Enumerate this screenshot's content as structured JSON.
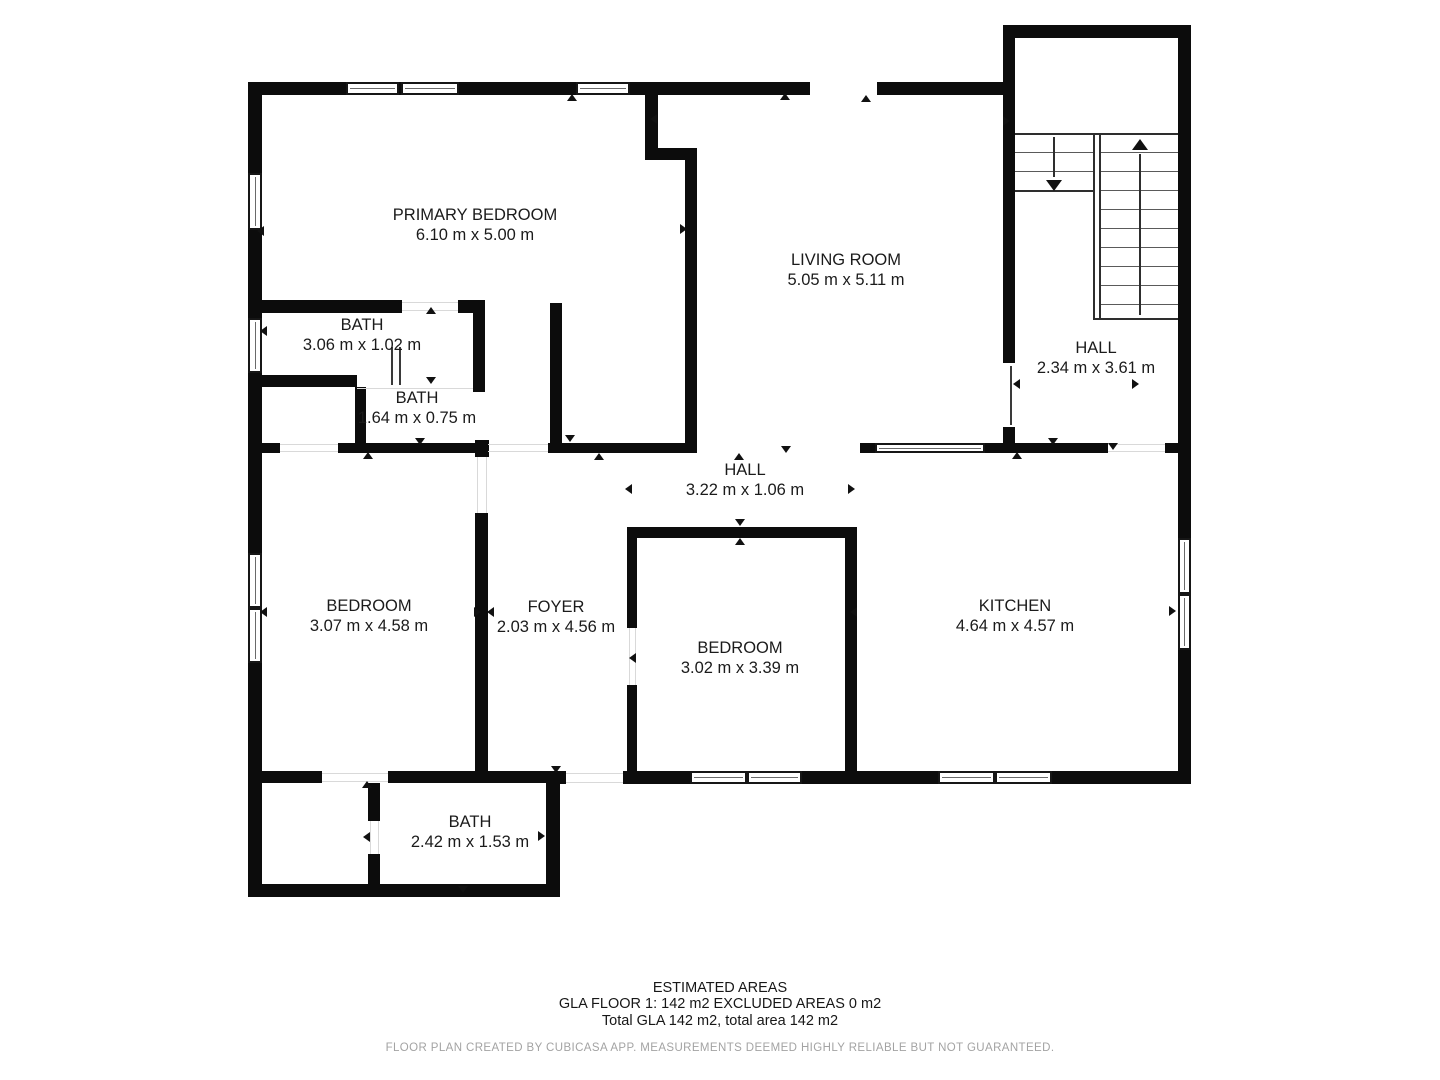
{
  "footer": {
    "title": "ESTIMATED AREAS",
    "line1": "GLA FLOOR 1: 142 m2 EXCLUDED AREAS 0 m2",
    "line2": "Total GLA 142 m2, total area 142 m2",
    "disclaimer": "FLOOR PLAN CREATED BY CUBICASA APP. MEASUREMENTS DEEMED HIGHLY RELIABLE BUT NOT GUARANTEED."
  },
  "colors": {
    "wall": "#0c0c0c",
    "label_text": "#1b1b1b",
    "disclaimer_text": "#a3a3a3"
  },
  "floorplan": {
    "rooms": [
      {
        "name": "PRIMARY BEDROOM",
        "dims": "6.10 m x 5.00 m",
        "x": 475,
        "y": 205
      },
      {
        "name": "LIVING ROOM",
        "dims": "5.05 m x 5.11 m",
        "x": 846,
        "y": 250
      },
      {
        "name": "BATH",
        "dims": "3.06 m x 1.02 m",
        "x": 362,
        "y": 315
      },
      {
        "name": "BATH",
        "dims": "1.64 m x 0.75 m",
        "x": 417,
        "y": 388
      },
      {
        "name": "HALL",
        "dims": "2.34 m x 3.61 m",
        "x": 1096,
        "y": 338
      },
      {
        "name": "HALL",
        "dims": "3.22 m x 1.06 m",
        "x": 745,
        "y": 460
      },
      {
        "name": "BEDROOM",
        "dims": "3.07 m x 4.58 m",
        "x": 369,
        "y": 596
      },
      {
        "name": "FOYER",
        "dims": "2.03 m x 4.56 m",
        "x": 556,
        "y": 597
      },
      {
        "name": "BEDROOM",
        "dims": "3.02 m x 3.39 m",
        "x": 740,
        "y": 638
      },
      {
        "name": "KITCHEN",
        "dims": "4.64 m x 4.57 m",
        "x": 1015,
        "y": 596
      },
      {
        "name": "BATH",
        "dims": "2.42 m x 1.53 m",
        "x": 470,
        "y": 812
      }
    ],
    "walls": [
      [
        248,
        82,
        14,
        815
      ],
      [
        248,
        82,
        562,
        13
      ],
      [
        877,
        82,
        138,
        13
      ],
      [
        1003,
        25,
        188,
        13
      ],
      [
        1003,
        25,
        12,
        70
      ],
      [
        1178,
        25,
        13,
        759
      ],
      [
        623,
        771,
        68,
        13
      ],
      [
        802,
        771,
        138,
        13
      ],
      [
        1050,
        771,
        141,
        13
      ],
      [
        546,
        771,
        20,
        13
      ],
      [
        546,
        771,
        14,
        126
      ],
      [
        248,
        884,
        312,
        13
      ],
      [
        250,
        771,
        72,
        12
      ],
      [
        388,
        771,
        158,
        12
      ],
      [
        645,
        95,
        13,
        60
      ],
      [
        645,
        148,
        52,
        12
      ],
      [
        685,
        148,
        12,
        304
      ],
      [
        1003,
        95,
        12,
        268
      ],
      [
        1003,
        427,
        12,
        25
      ],
      [
        250,
        300,
        152,
        13
      ],
      [
        458,
        300,
        27,
        13
      ],
      [
        473,
        300,
        12,
        92
      ],
      [
        250,
        375,
        107,
        12
      ],
      [
        355,
        387,
        11,
        58
      ],
      [
        550,
        303,
        12,
        148
      ],
      [
        250,
        443,
        30,
        10
      ],
      [
        338,
        443,
        137,
        10
      ],
      [
        475,
        440,
        14,
        17
      ],
      [
        548,
        443,
        149,
        10
      ],
      [
        475,
        513,
        13,
        260
      ],
      [
        627,
        527,
        226,
        11
      ],
      [
        627,
        527,
        10,
        101
      ],
      [
        627,
        685,
        10,
        88
      ],
      [
        845,
        527,
        12,
        246
      ],
      [
        860,
        443,
        16,
        10
      ],
      [
        984,
        443,
        124,
        10
      ],
      [
        1165,
        443,
        26,
        10
      ],
      [
        368,
        783,
        12,
        38
      ],
      [
        368,
        854,
        12,
        31
      ]
    ],
    "windows": [
      [
        346,
        82,
        53,
        13,
        "h"
      ],
      [
        401,
        82,
        58,
        13,
        "h"
      ],
      [
        576,
        82,
        54,
        13,
        "h"
      ],
      [
        248,
        173,
        14,
        57,
        "v"
      ],
      [
        248,
        318,
        14,
        55,
        "v"
      ],
      [
        248,
        553,
        14,
        55,
        "v"
      ],
      [
        248,
        608,
        14,
        55,
        "v"
      ],
      [
        1178,
        538,
        13,
        56,
        "v"
      ],
      [
        1178,
        594,
        13,
        56,
        "v"
      ],
      [
        690,
        771,
        57,
        13,
        "h"
      ],
      [
        747,
        771,
        55,
        13,
        "h"
      ],
      [
        938,
        771,
        57,
        13,
        "h"
      ],
      [
        995,
        771,
        57,
        13,
        "h"
      ],
      [
        875,
        443,
        110,
        10,
        "h"
      ]
    ],
    "jambs": [
      [
        391,
        347,
        2,
        38
      ],
      [
        399,
        347,
        2,
        38
      ],
      [
        1010,
        366,
        2,
        59
      ]
    ],
    "thresholds": [
      [
        280,
        444,
        58,
        1
      ],
      [
        280,
        451,
        58,
        1
      ],
      [
        402,
        302,
        56,
        1
      ],
      [
        402,
        310,
        56,
        1
      ],
      [
        477,
        457,
        1,
        56
      ],
      [
        486,
        457,
        1,
        56
      ],
      [
        566,
        773,
        57,
        1
      ],
      [
        566,
        782,
        57,
        1
      ],
      [
        322,
        773,
        66,
        1
      ],
      [
        322,
        781,
        66,
        1
      ],
      [
        370,
        821,
        1,
        33
      ],
      [
        378,
        821,
        1,
        33
      ],
      [
        1108,
        444,
        57,
        1
      ],
      [
        1108,
        451,
        57,
        1
      ],
      [
        629,
        628,
        1,
        57
      ],
      [
        635,
        628,
        1,
        57
      ],
      [
        488,
        444,
        60,
        1
      ],
      [
        488,
        451,
        60,
        1
      ],
      [
        357,
        388,
        116,
        1
      ]
    ],
    "markers": [
      [
        572,
        97,
        "up"
      ],
      [
        785,
        96,
        "up"
      ],
      [
        866,
        98,
        "up"
      ],
      [
        653,
        119,
        "left"
      ],
      [
        1006,
        121,
        "right"
      ],
      [
        683,
        229,
        "right"
      ],
      [
        260,
        231,
        "left"
      ],
      [
        431,
        310,
        "up"
      ],
      [
        263,
        331,
        "left"
      ],
      [
        431,
        380,
        "down"
      ],
      [
        1016,
        384,
        "left"
      ],
      [
        1135,
        384,
        "right"
      ],
      [
        570,
        438,
        "down"
      ],
      [
        420,
        441,
        "down"
      ],
      [
        739,
        456,
        "up"
      ],
      [
        786,
        449,
        "down"
      ],
      [
        368,
        455,
        "up"
      ],
      [
        599,
        456,
        "up"
      ],
      [
        1017,
        455,
        "up"
      ],
      [
        1053,
        441,
        "down"
      ],
      [
        1113,
        446,
        "down"
      ],
      [
        628,
        489,
        "left"
      ],
      [
        851,
        489,
        "right"
      ],
      [
        740,
        522,
        "down"
      ],
      [
        740,
        541,
        "up"
      ],
      [
        263,
        612,
        "left"
      ],
      [
        477,
        612,
        "right"
      ],
      [
        490,
        612,
        "left"
      ],
      [
        632,
        658,
        "left"
      ],
      [
        853,
        612,
        "left"
      ],
      [
        1172,
        611,
        "right"
      ],
      [
        367,
        784,
        "up"
      ],
      [
        556,
        769,
        "down"
      ],
      [
        366,
        837,
        "left"
      ],
      [
        541,
        836,
        "right"
      ],
      [
        463,
        889,
        "down"
      ]
    ],
    "stairs": {
      "top": 133,
      "x": 1015,
      "w": 163,
      "left": {
        "x": 1015,
        "w": 78,
        "treads": [
          152,
          171
        ],
        "bottom": 190,
        "arrow": {
          "x": 1053,
          "from": 137,
          "to": 183,
          "dir": "down"
        }
      },
      "divider": {
        "x1": 1093,
        "x2": 1099,
        "top": 133,
        "bottom": 318
      },
      "right": {
        "x": 1101,
        "w": 77,
        "treads": [
          152,
          171,
          190,
          209,
          228,
          247,
          266,
          285,
          304
        ],
        "bottom": 318,
        "arrow": {
          "x": 1139,
          "from": 150,
          "to": 315,
          "dir": "up"
        }
      }
    }
  }
}
